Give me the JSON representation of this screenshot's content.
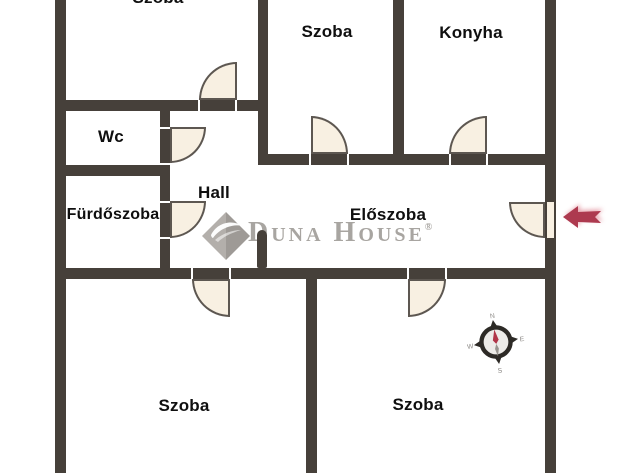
{
  "colors": {
    "wall": "#46403a",
    "door_fill": "#f8f0e2",
    "door_stroke": "#5d5751",
    "watermark": "#a8a5a1",
    "arrow": "#ad3a4f",
    "compass_ring": "#2d2a26",
    "needle_red": "#b13548",
    "needle_gray": "#98948f",
    "label": "#0f0f0f"
  },
  "rooms": [
    {
      "id": "szoba-top-left",
      "label": "Szoba"
    },
    {
      "id": "szoba-top-middle",
      "label": "Szoba"
    },
    {
      "id": "konyha",
      "label": "Konyha"
    },
    {
      "id": "wc",
      "label": "Wc"
    },
    {
      "id": "furdoszoba",
      "label": "Fürdőszoba"
    },
    {
      "id": "hall",
      "label": "Hall"
    },
    {
      "id": "eloszoba",
      "label": "Előszoba"
    },
    {
      "id": "szoba-bottom-left",
      "label": "Szoba"
    },
    {
      "id": "szoba-bottom-right",
      "label": "Szoba"
    }
  ],
  "watermark": {
    "brand": "Duna House",
    "registered": "®"
  },
  "compass": {
    "north": "N",
    "east": "E",
    "south": "S",
    "west": "W"
  }
}
